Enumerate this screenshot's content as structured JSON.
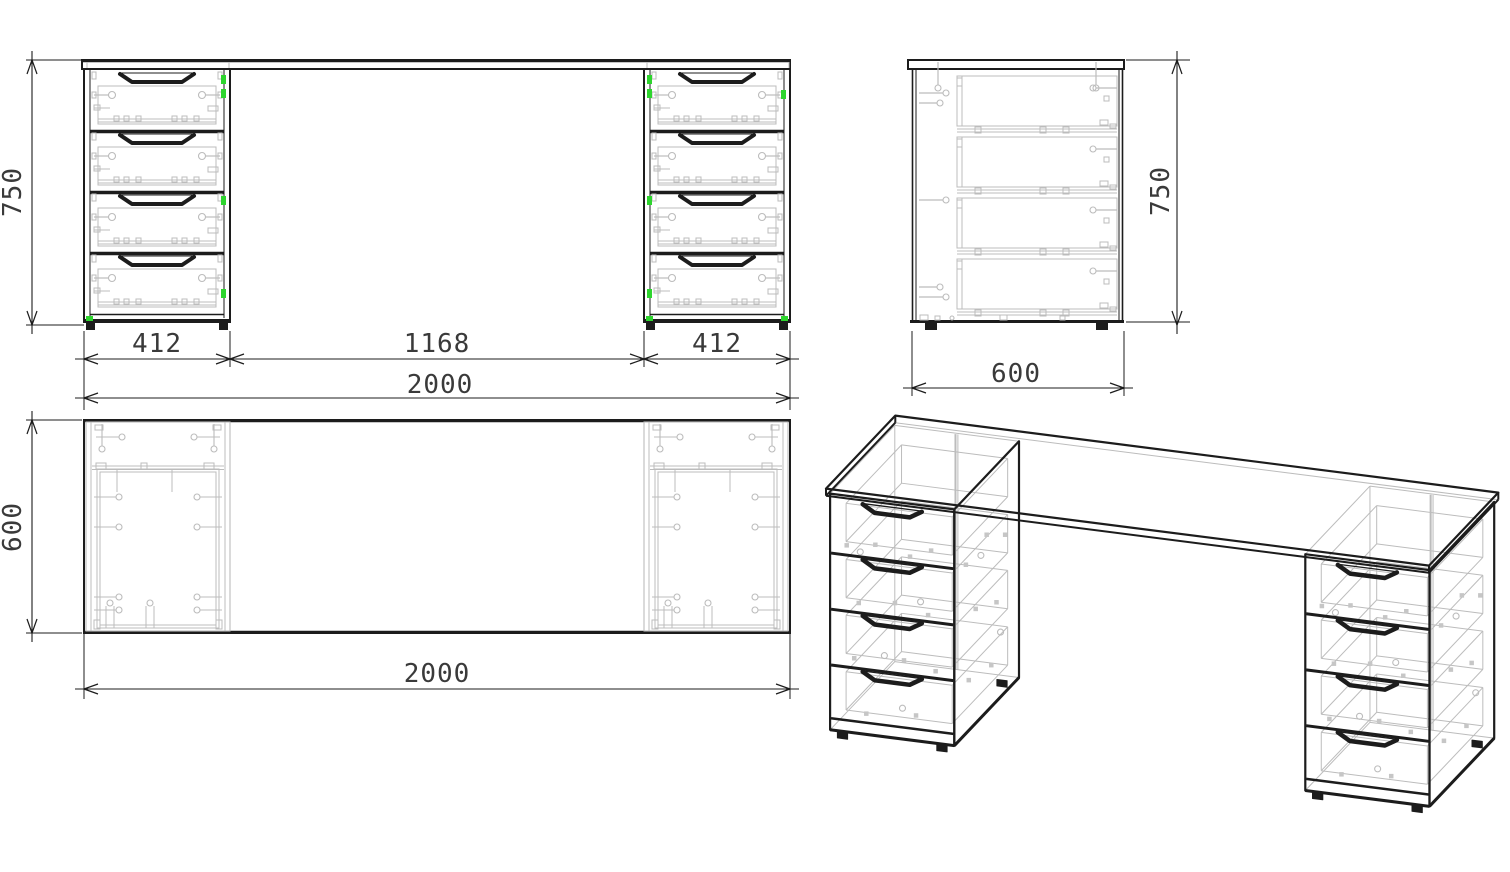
{
  "meta": {
    "drawing_type": "furniture technical drawing",
    "subject": "two-pedestal writing desk with eight drawers",
    "units": "mm"
  },
  "colors": {
    "line": "#1c1c1c",
    "hidden": "#bcbcbc",
    "accent_green": "#2ed52e",
    "dim_text": "#3a3a3a",
    "background": "#ffffff"
  },
  "desk": {
    "width": 2000,
    "depth": 600,
    "height": 750,
    "pedestal_width": 412,
    "knee_gap": 1168,
    "pedestal_count": 2,
    "drawers_per_pedestal": 4,
    "desktop_thickness": 22
  },
  "dimensions": {
    "front": {
      "pedestal_left": "412",
      "knee_gap": "1168",
      "pedestal_right": "412",
      "total_width": "2000",
      "height": "750"
    },
    "side": {
      "depth": "600",
      "height": "750"
    },
    "top": {
      "depth": "600",
      "total_width": "2000"
    }
  }
}
